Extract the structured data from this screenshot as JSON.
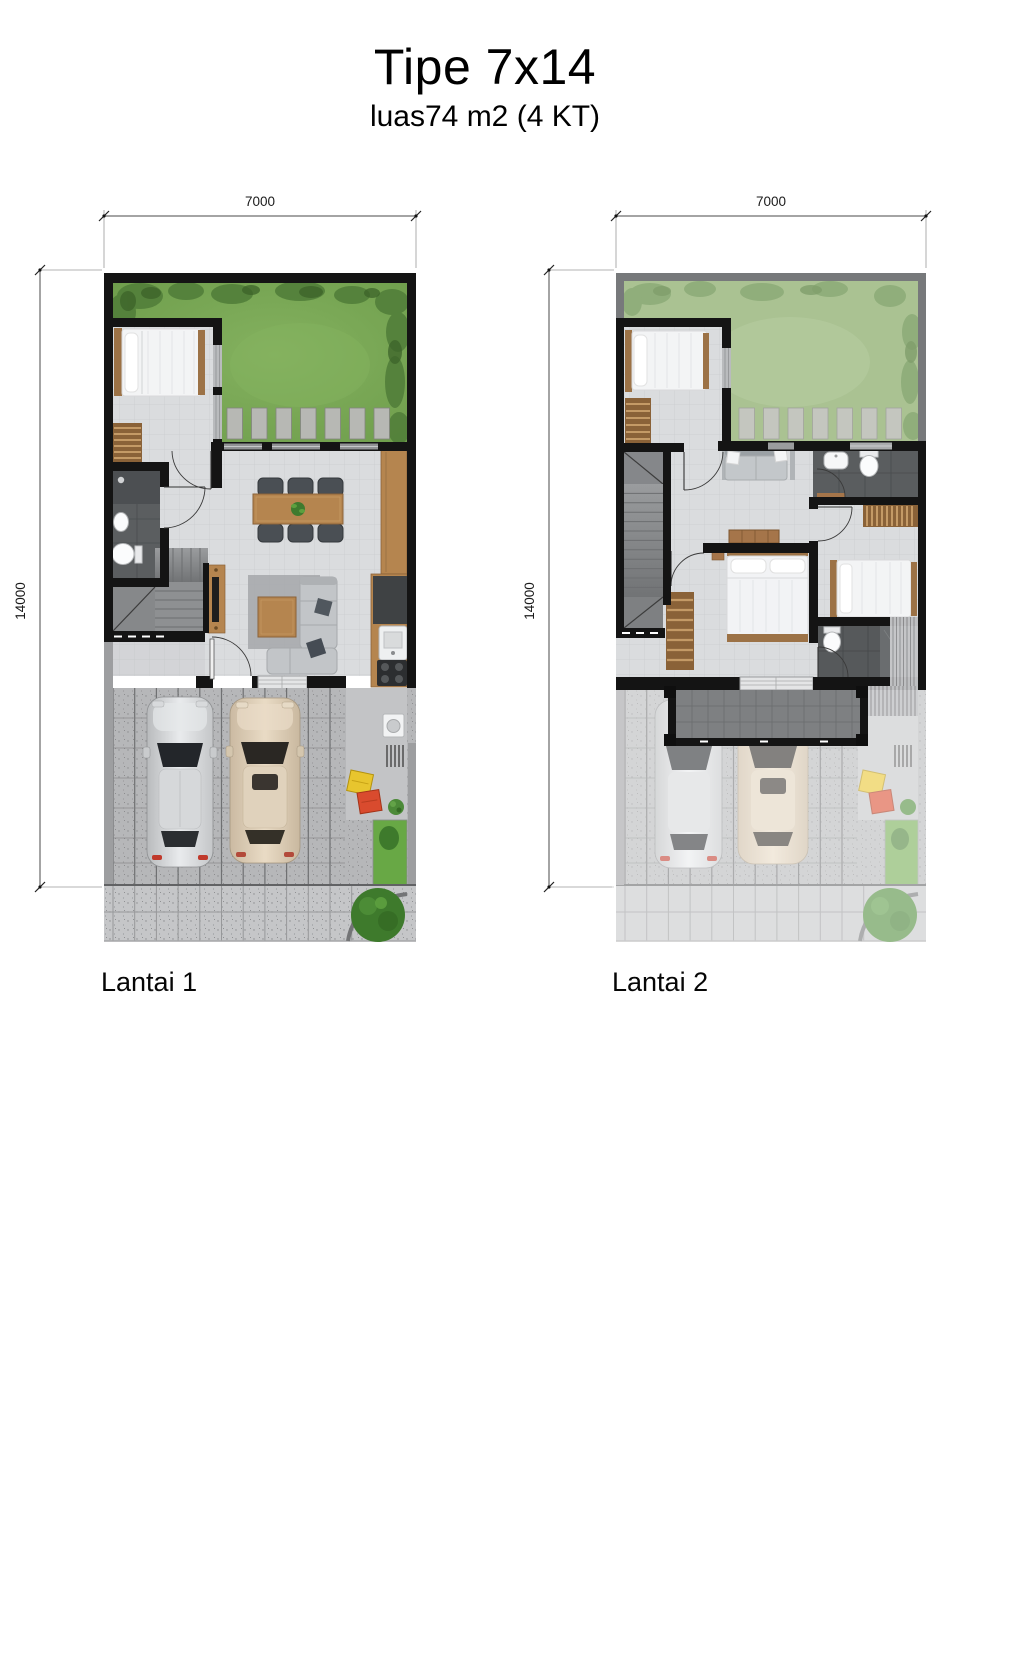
{
  "header": {
    "title": "Tipe 7x14",
    "subtitle": "luas74 m2 (4 KT)"
  },
  "plan1": {
    "label": "Lantai 1",
    "dim_width": "7000",
    "dim_height": "14000"
  },
  "plan2": {
    "label": "Lantai 2",
    "dim_width": "7000",
    "dim_height": "14000"
  },
  "palette": {
    "wall": "#141414",
    "parapet": "#77797b",
    "garden_floor1": "#79a854",
    "garden_floor2": "#aac292",
    "bush_dark": "#466f31",
    "floor_tile": "#dadcde",
    "bath_floor": "#5b5e60",
    "wood": "#b5854f",
    "wood_dark": "#8a6238",
    "paving": "#b6b7b9",
    "sidewalk": "#c5c6c8",
    "grass_strip": "#68a845",
    "car_silver": "#d4d6d8",
    "car_beige": "#d9c8b2",
    "bin_yellow": "#e8c52e",
    "bin_red": "#d94b2e",
    "sofa": "#c2c5c8",
    "balcony_floor": "#7e8082"
  }
}
